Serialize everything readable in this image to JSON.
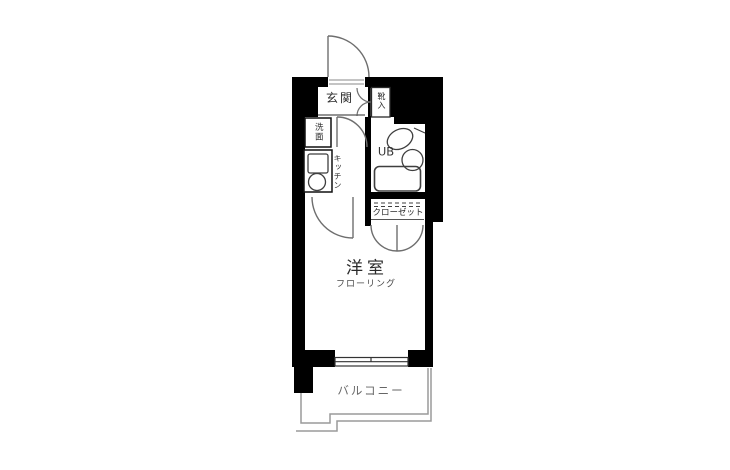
{
  "floorplan": {
    "colors": {
      "background": "#ffffff",
      "wall": "#000000",
      "fixture_line": "#3f3f3f",
      "door_line": "#777777",
      "balcony_line": "#9a9a9a"
    },
    "rooms": {
      "entrance": {
        "label": "玄関"
      },
      "shoe_box": {
        "label": "靴入"
      },
      "washbasin": {
        "label": "洗面"
      },
      "kitchen": {
        "label": "キッチン"
      },
      "unit_bath": {
        "label": "UB"
      },
      "closet": {
        "label": "クローゼット"
      },
      "main_room": {
        "label": "洋室",
        "floor_note": "フローリング"
      },
      "balcony": {
        "label": "バルコニー"
      }
    }
  }
}
